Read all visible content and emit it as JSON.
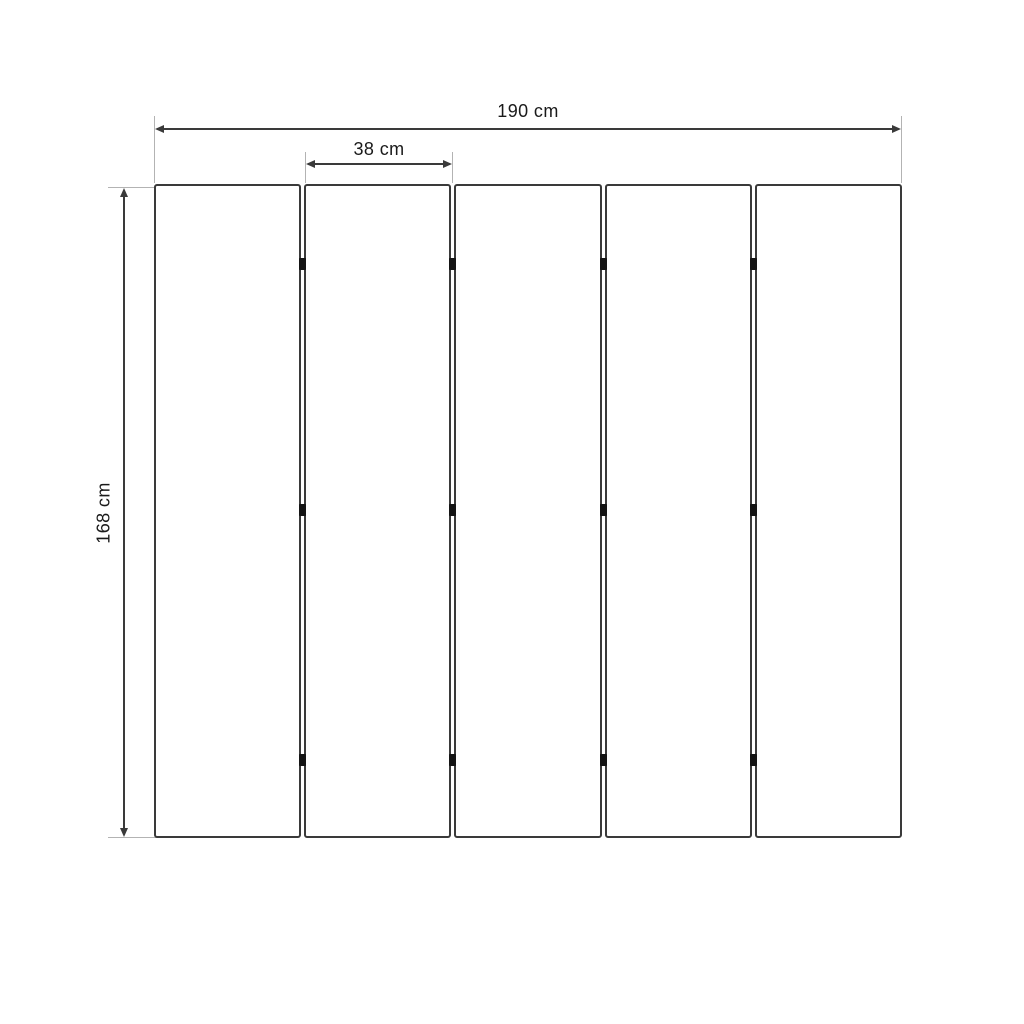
{
  "diagram": {
    "labels": {
      "total_width": "190 cm",
      "panel_width": "38 cm",
      "height": "168 cm"
    },
    "panel_count": 5,
    "hinges_per_gap": 3,
    "colors": {
      "line": "#3a3a3a",
      "extension": "#b3b3b3",
      "hinge": "#141414",
      "text": "#1a1a1a",
      "background": "#ffffff"
    }
  }
}
